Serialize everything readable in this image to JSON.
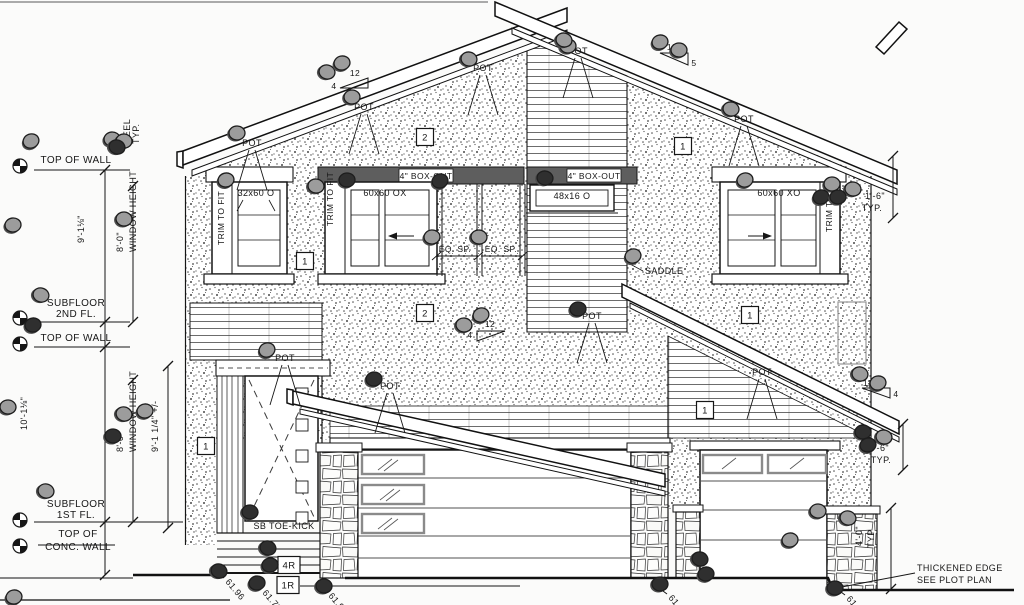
{
  "drawing_type": "house front elevation blueprint",
  "colors": {
    "ink": "#161616",
    "paper": "#fbfbfa",
    "boxout_band": "#5e5e5e",
    "marker_gray": "#9c9c9c",
    "marker_dark": "#2f2f2f",
    "stone_line": "#333333",
    "utility_box": "#999999"
  },
  "pot_label": "POT",
  "texts": [
    {
      "t": "TOP OF WALL",
      "x": 76,
      "y": 163,
      "a": "middle",
      "s": 10
    },
    {
      "t": "12\"",
      "x": 120,
      "y": 148,
      "r": -90
    },
    {
      "t": "HEEL",
      "x": 130,
      "y": 144,
      "r": -90
    },
    {
      "t": "TYP.",
      "x": 139,
      "y": 144,
      "r": -90
    },
    {
      "t": "9'-1⅛\"",
      "x": 84,
      "y": 243,
      "r": -90
    },
    {
      "t": "8'-0\"",
      "x": 123,
      "y": 252,
      "r": -90
    },
    {
      "t": "WINDOW HEIGHT",
      "x": 136,
      "y": 252,
      "r": -90
    },
    {
      "t": "SUBFLOOR",
      "x": 76,
      "y": 306,
      "a": "middle",
      "s": 10
    },
    {
      "t": "2ND FL.",
      "x": 76,
      "y": 317,
      "a": "middle",
      "s": 10
    },
    {
      "t": "TOP OF WALL",
      "x": 76,
      "y": 341,
      "a": "middle",
      "s": 10
    },
    {
      "t": "10'-1⅛\"",
      "x": 27,
      "y": 430,
      "r": -90
    },
    {
      "t": "8'-0\"",
      "x": 123,
      "y": 452,
      "r": -90
    },
    {
      "t": "WINDOW HEIGHT",
      "x": 136,
      "y": 452,
      "r": -90
    },
    {
      "t": "9'-1 1/4\" +/-",
      "x": 158,
      "y": 452,
      "r": -90
    },
    {
      "t": "SUBFLOOR",
      "x": 76,
      "y": 507,
      "a": "middle",
      "s": 10
    },
    {
      "t": "1ST FL.",
      "x": 76,
      "y": 518,
      "a": "middle",
      "s": 10
    },
    {
      "t": "TOP OF",
      "x": 78,
      "y": 537,
      "a": "middle",
      "s": 10
    },
    {
      "t": "CONC. WALL",
      "x": 78,
      "y": 550,
      "a": "middle",
      "s": 10
    },
    {
      "t": "32x60 O",
      "x": 256,
      "y": 196,
      "a": "middle"
    },
    {
      "t": "TRIM TO FIT",
      "x": 224,
      "y": 245,
      "r": -90,
      "s": 8.5
    },
    {
      "t": "60x60 OX",
      "x": 385,
      "y": 196,
      "a": "middle"
    },
    {
      "t": "TRIM TO FIT",
      "x": 333,
      "y": 226,
      "r": -90,
      "s": 8.5
    },
    {
      "t": "4\" BOX-OUT",
      "x": 426,
      "y": 179,
      "a": "middle",
      "s": 8.5
    },
    {
      "t": "4\" BOX-OUT",
      "x": 594,
      "y": 179,
      "a": "middle",
      "s": 8.5
    },
    {
      "t": "EQ. SP.",
      "x": 455,
      "y": 252,
      "a": "middle",
      "s": 8.5
    },
    {
      "t": "EQ. SP.",
      "x": 501,
      "y": 252,
      "a": "middle",
      "s": 8.5
    },
    {
      "t": "48x16 O",
      "x": 572,
      "y": 199,
      "a": "middle"
    },
    {
      "t": "60x60 XO",
      "x": 779,
      "y": 196,
      "a": "middle"
    },
    {
      "t": "TRIM TO FIT",
      "x": 832,
      "y": 232,
      "r": -90,
      "s": 8.5
    },
    {
      "t": "1'-6\"",
      "x": 875,
      "y": 199,
      "a": "middle"
    },
    {
      "t": "TYP.",
      "x": 872,
      "y": 211,
      "a": "middle"
    },
    {
      "t": "SADDLE",
      "x": 645,
      "y": 274,
      "a": "start"
    },
    {
      "t": "SB TOE-KICK",
      "x": 284,
      "y": 529,
      "a": "middle"
    },
    {
      "t": "THICKENED EDGE",
      "x": 917,
      "y": 571,
      "a": "start"
    },
    {
      "t": "SEE PLOT PLAN",
      "x": 917,
      "y": 583,
      "a": "start"
    },
    {
      "t": "1'-6\"",
      "x": 879,
      "y": 451,
      "a": "middle"
    },
    {
      "t": "TYP.",
      "x": 881,
      "y": 463,
      "a": "middle"
    },
    {
      "t": "4'-0\"",
      "x": 862,
      "y": 546,
      "r": -90
    },
    {
      "t": "TYP",
      "x": 874,
      "y": 548,
      "r": -90
    },
    {
      "t": "12",
      "x": 355,
      "y": 76,
      "a": "middle",
      "s": 8.5
    },
    {
      "t": "4",
      "x": 334,
      "y": 89,
      "a": "middle",
      "s": 8.5
    },
    {
      "t": "12",
      "x": 672,
      "y": 50,
      "a": "middle",
      "s": 8.5
    },
    {
      "t": "5",
      "x": 694,
      "y": 66,
      "a": "middle",
      "s": 8.5
    },
    {
      "t": "12",
      "x": 490,
      "y": 327,
      "a": "middle",
      "s": 8.5
    },
    {
      "t": "4",
      "x": 470,
      "y": 338,
      "a": "middle",
      "s": 8.5
    },
    {
      "t": "12",
      "x": 868,
      "y": 386,
      "a": "middle",
      "s": 8.5
    },
    {
      "t": "4",
      "x": 896,
      "y": 397,
      "a": "middle",
      "s": 8.5
    }
  ],
  "pot_positions": [
    {
      "x": 252,
      "y": 146
    },
    {
      "x": 364,
      "y": 110
    },
    {
      "x": 483,
      "y": 71
    },
    {
      "x": 578,
      "y": 54
    },
    {
      "x": 744,
      "y": 122
    },
    {
      "x": 285,
      "y": 361
    },
    {
      "x": 390,
      "y": 389
    },
    {
      "x": 592,
      "y": 319
    },
    {
      "x": 762,
      "y": 375
    }
  ],
  "keynotes": [
    {
      "n": "2",
      "x": 425,
      "y": 137
    },
    {
      "n": "1",
      "x": 683,
      "y": 146
    },
    {
      "n": "1",
      "x": 305,
      "y": 261
    },
    {
      "n": "2",
      "x": 425,
      "y": 313
    },
    {
      "n": "1",
      "x": 750,
      "y": 315
    },
    {
      "n": "1",
      "x": 206,
      "y": 446
    },
    {
      "n": "1",
      "x": 705,
      "y": 410
    },
    {
      "n": "4R",
      "x": 289,
      "y": 565
    },
    {
      "n": "1R",
      "x": 288,
      "y": 585
    }
  ],
  "spot_elevations": [
    {
      "v": "61.96",
      "bx": 216,
      "by": 572,
      "tx": 224,
      "ty": 578
    },
    {
      "v": "61.79",
      "bx": 253,
      "by": 583,
      "tx": 261,
      "ty": 589
    },
    {
      "v": "61.96",
      "bx": 319,
      "by": 586,
      "tx": 327,
      "ty": 592
    },
    {
      "v": "61.69",
      "bx": 659,
      "by": 588,
      "tx": 667,
      "ty": 594
    },
    {
      "v": "61.69",
      "bx": 837,
      "by": 589,
      "tx": 845,
      "ty": 595
    }
  ],
  "markers": [
    [
      31,
      141
    ],
    [
      112,
      139
    ],
    [
      124,
      141
    ],
    [
      117,
      147,
      1
    ],
    [
      13,
      225
    ],
    [
      124,
      219
    ],
    [
      41,
      295
    ],
    [
      33,
      325,
      1
    ],
    [
      8,
      407
    ],
    [
      124,
      414
    ],
    [
      145,
      411
    ],
    [
      113,
      436,
      1
    ],
    [
      46,
      491
    ],
    [
      14,
      597
    ],
    [
      237,
      133
    ],
    [
      327,
      72
    ],
    [
      342,
      63
    ],
    [
      352,
      97
    ],
    [
      469,
      59
    ],
    [
      226,
      180
    ],
    [
      568,
      46
    ],
    [
      564,
      40
    ],
    [
      660,
      42
    ],
    [
      679,
      50
    ],
    [
      731,
      109
    ],
    [
      745,
      180
    ],
    [
      832,
      184
    ],
    [
      853,
      189
    ],
    [
      821,
      197,
      1
    ],
    [
      838,
      197,
      1
    ],
    [
      545,
      178,
      1
    ],
    [
      440,
      181,
      1
    ],
    [
      347,
      180,
      1
    ],
    [
      316,
      186
    ],
    [
      633,
      256
    ],
    [
      578,
      309,
      1
    ],
    [
      464,
      325
    ],
    [
      481,
      315
    ],
    [
      432,
      237
    ],
    [
      479,
      237
    ],
    [
      267,
      350
    ],
    [
      374,
      379,
      1
    ],
    [
      250,
      512,
      1
    ],
    [
      219,
      571,
      1
    ],
    [
      257,
      583,
      1
    ],
    [
      324,
      586,
      1
    ],
    [
      268,
      548,
      1
    ],
    [
      270,
      565,
      1
    ],
    [
      660,
      584,
      1
    ],
    [
      700,
      559,
      1
    ],
    [
      706,
      574,
      1
    ],
    [
      818,
      511
    ],
    [
      848,
      518
    ],
    [
      790,
      540
    ],
    [
      835,
      588,
      1
    ],
    [
      860,
      374
    ],
    [
      878,
      383
    ],
    [
      863,
      432,
      1
    ],
    [
      884,
      437
    ],
    [
      868,
      445,
      1
    ]
  ]
}
